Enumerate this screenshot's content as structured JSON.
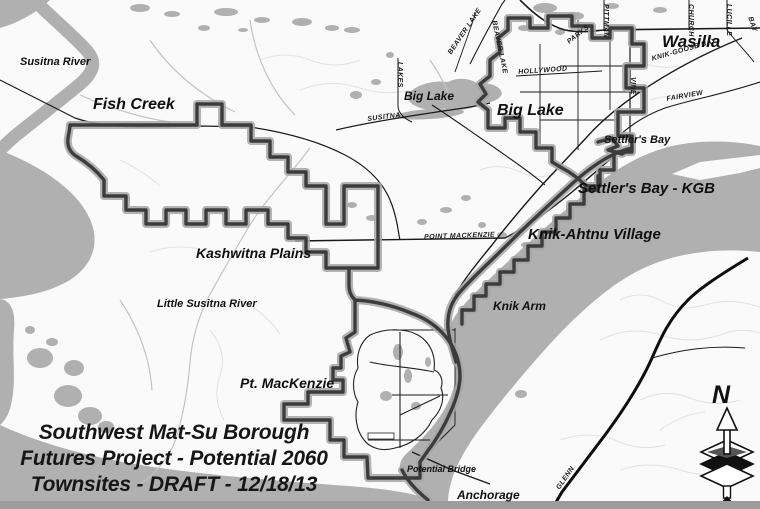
{
  "map": {
    "region": "Southwest Mat-Su Borough"
  },
  "title": {
    "line1": "Southwest Mat-Su Borough",
    "line2": "Futures Project - Potential 2060",
    "line3": "Townsites - DRAFT - 12/18/13"
  },
  "townsite_labels": {
    "fish_creek": "Fish Creek",
    "big_lake": "Big Lake",
    "settlers_bay_kgb": "Settler's Bay - KGB",
    "knik_ahtnu_village": "Knik-Ahtnu Village",
    "kashwitna_plains": "Kashwitna Plains",
    "pt_mackenzie": "Pt. MacKenzie"
  },
  "place_labels": {
    "wasilla": "Wasilla",
    "anchorage": "Anchorage",
    "settlers_bay": "Settler's Bay",
    "potential_bridge": "Potential Bridge"
  },
  "water_labels": {
    "susitna_river": "Susitna River",
    "little_susitna_river": "Little Susitna River",
    "big_lake": "Big Lake",
    "knik_arm": "Knik Arm"
  },
  "road_labels": {
    "parks": "PARKS",
    "pittman": "PITTMAN",
    "church": "CHURCH",
    "lucille": "LUCILLE",
    "vine": "VINE",
    "bay": "BAY",
    "knik_goose_bay": "KNIK-GOOSE BAY",
    "fairview": "FAIRVIEW",
    "hollywood": "HOLLYWOOD",
    "beaver_lake": "BEAVER LAKE",
    "beaver_lake_2": "BEAVER LAKE",
    "lakes": "LAKES",
    "susitna": "SUSITNA",
    "point_mackenzie": "POINT MACKENZIE",
    "glenn": "GLENN"
  },
  "compass": {
    "north": "N"
  },
  "colors": {
    "water": "#b0b0b0",
    "land": "#fafafa",
    "boundary": "#3c3c3c",
    "boundary_halo": "#a6a6a6",
    "road": "#1a1a1a",
    "label": "#0f0f0f",
    "footer_bar": "#9c9c9c"
  }
}
